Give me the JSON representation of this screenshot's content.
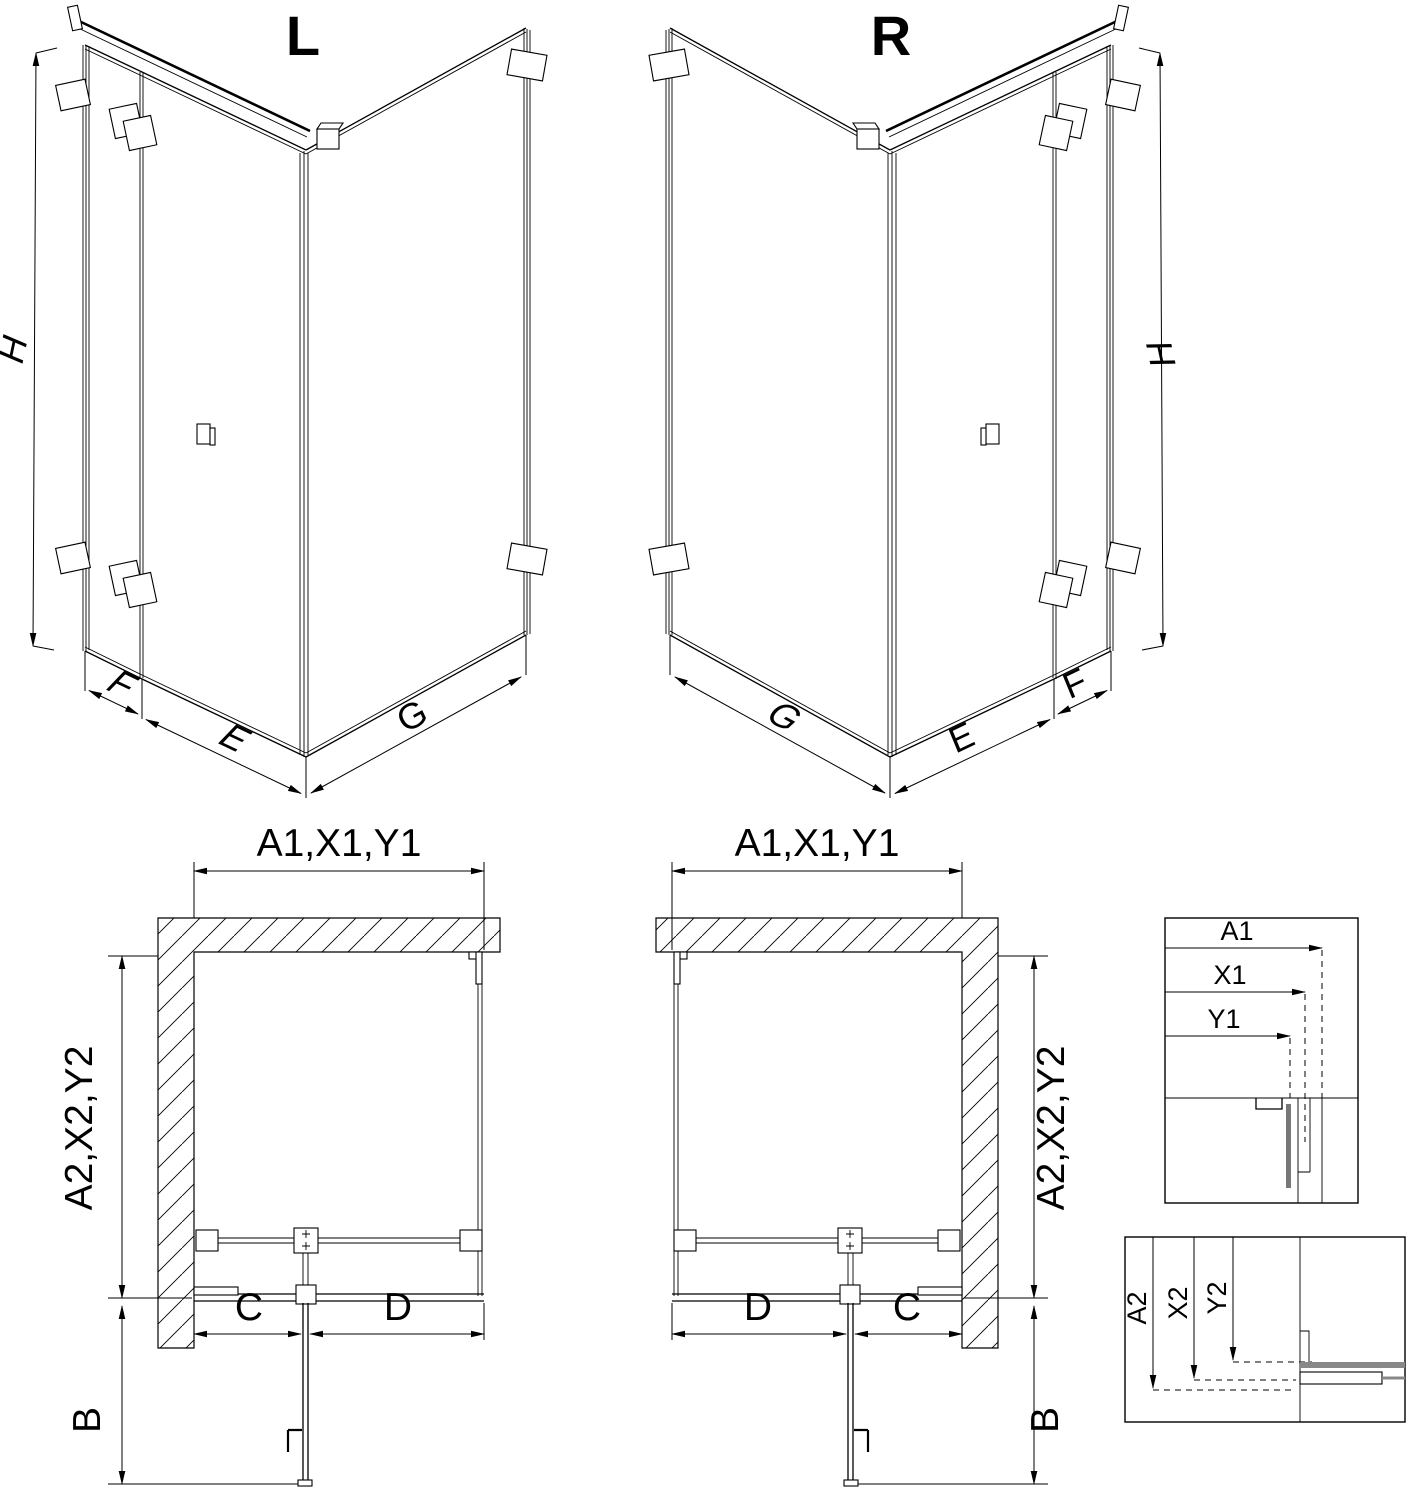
{
  "drawing": {
    "iso_left": {
      "title": "L",
      "dim_height": "H",
      "dim_side_fixed": "F",
      "dim_door": "E",
      "dim_return": "G"
    },
    "iso_right": {
      "title": "R",
      "dim_height": "H",
      "dim_side_fixed": "F",
      "dim_door": "E",
      "dim_return": "G"
    },
    "plan_left": {
      "dim_top": "A1,X1,Y1",
      "dim_side": "A2,X2,Y2",
      "dim_door_width": "C",
      "dim_fixed_width": "D",
      "dim_door_open": "B"
    },
    "plan_right": {
      "dim_top": "A1,X1,Y1",
      "dim_side": "A2,X2,Y2",
      "dim_door_width": "C",
      "dim_fixed_width": "D",
      "dim_door_open": "B"
    },
    "detail_width": {
      "a1": "A1",
      "x1": "X1",
      "y1": "Y1"
    },
    "detail_depth": {
      "a2": "A2",
      "x2": "X2",
      "y2": "Y2"
    }
  }
}
